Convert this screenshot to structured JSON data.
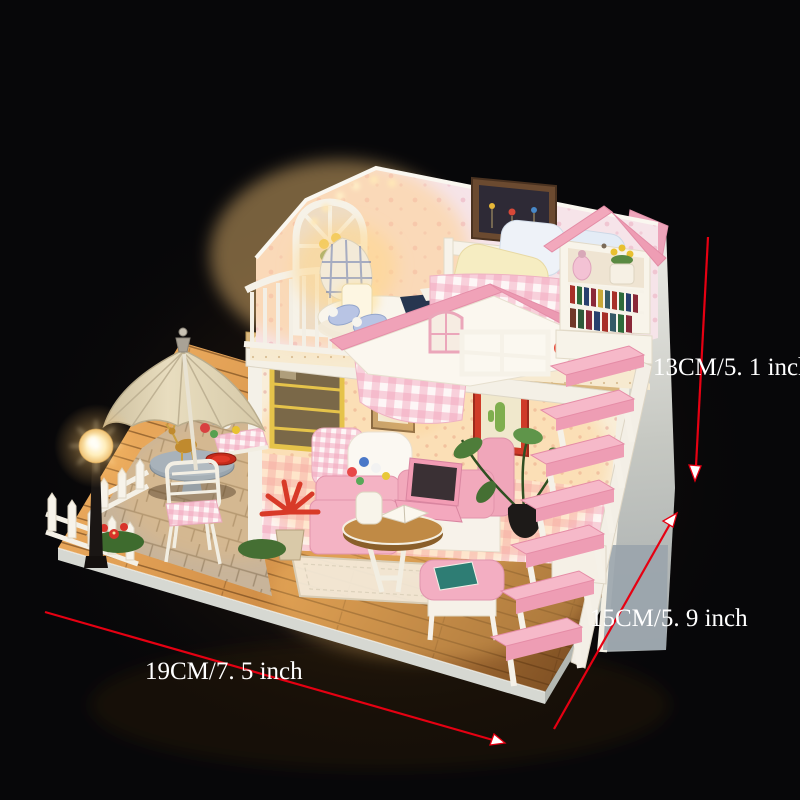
{
  "image": {
    "type": "product-photo",
    "subject": "DIY miniature wooden dollhouse loft kit with pink roof, LED lights, terrace umbrella and staircase, photographed on a black background",
    "background_color": "#070709"
  },
  "annotations": {
    "arrow_color": "#e60012",
    "label_color": "#ffffff",
    "height": {
      "label": "13CM/5. 1 inch",
      "orientation": "vertical"
    },
    "depth": {
      "label": "15CM/5. 9 inch",
      "orientation": "diagonal"
    },
    "width": {
      "label": "19CM/7. 5 inch",
      "orientation": "horizontal"
    }
  },
  "palette": {
    "roof_pink": "#efa2b8",
    "stair_pink": "#f3abc0",
    "gingham_pink": "#f2a4ba",
    "wallpaper_cream": "#f8ecd8",
    "heart_wallpaper": "#f6e4e9",
    "wood_floor": "#c98a42",
    "platform_gray": "#d6d8d2",
    "umbrella_beige": "#e3d7ba",
    "lamp_glow": "#ffd894",
    "right_wall_gray": "#b9c0c2"
  }
}
